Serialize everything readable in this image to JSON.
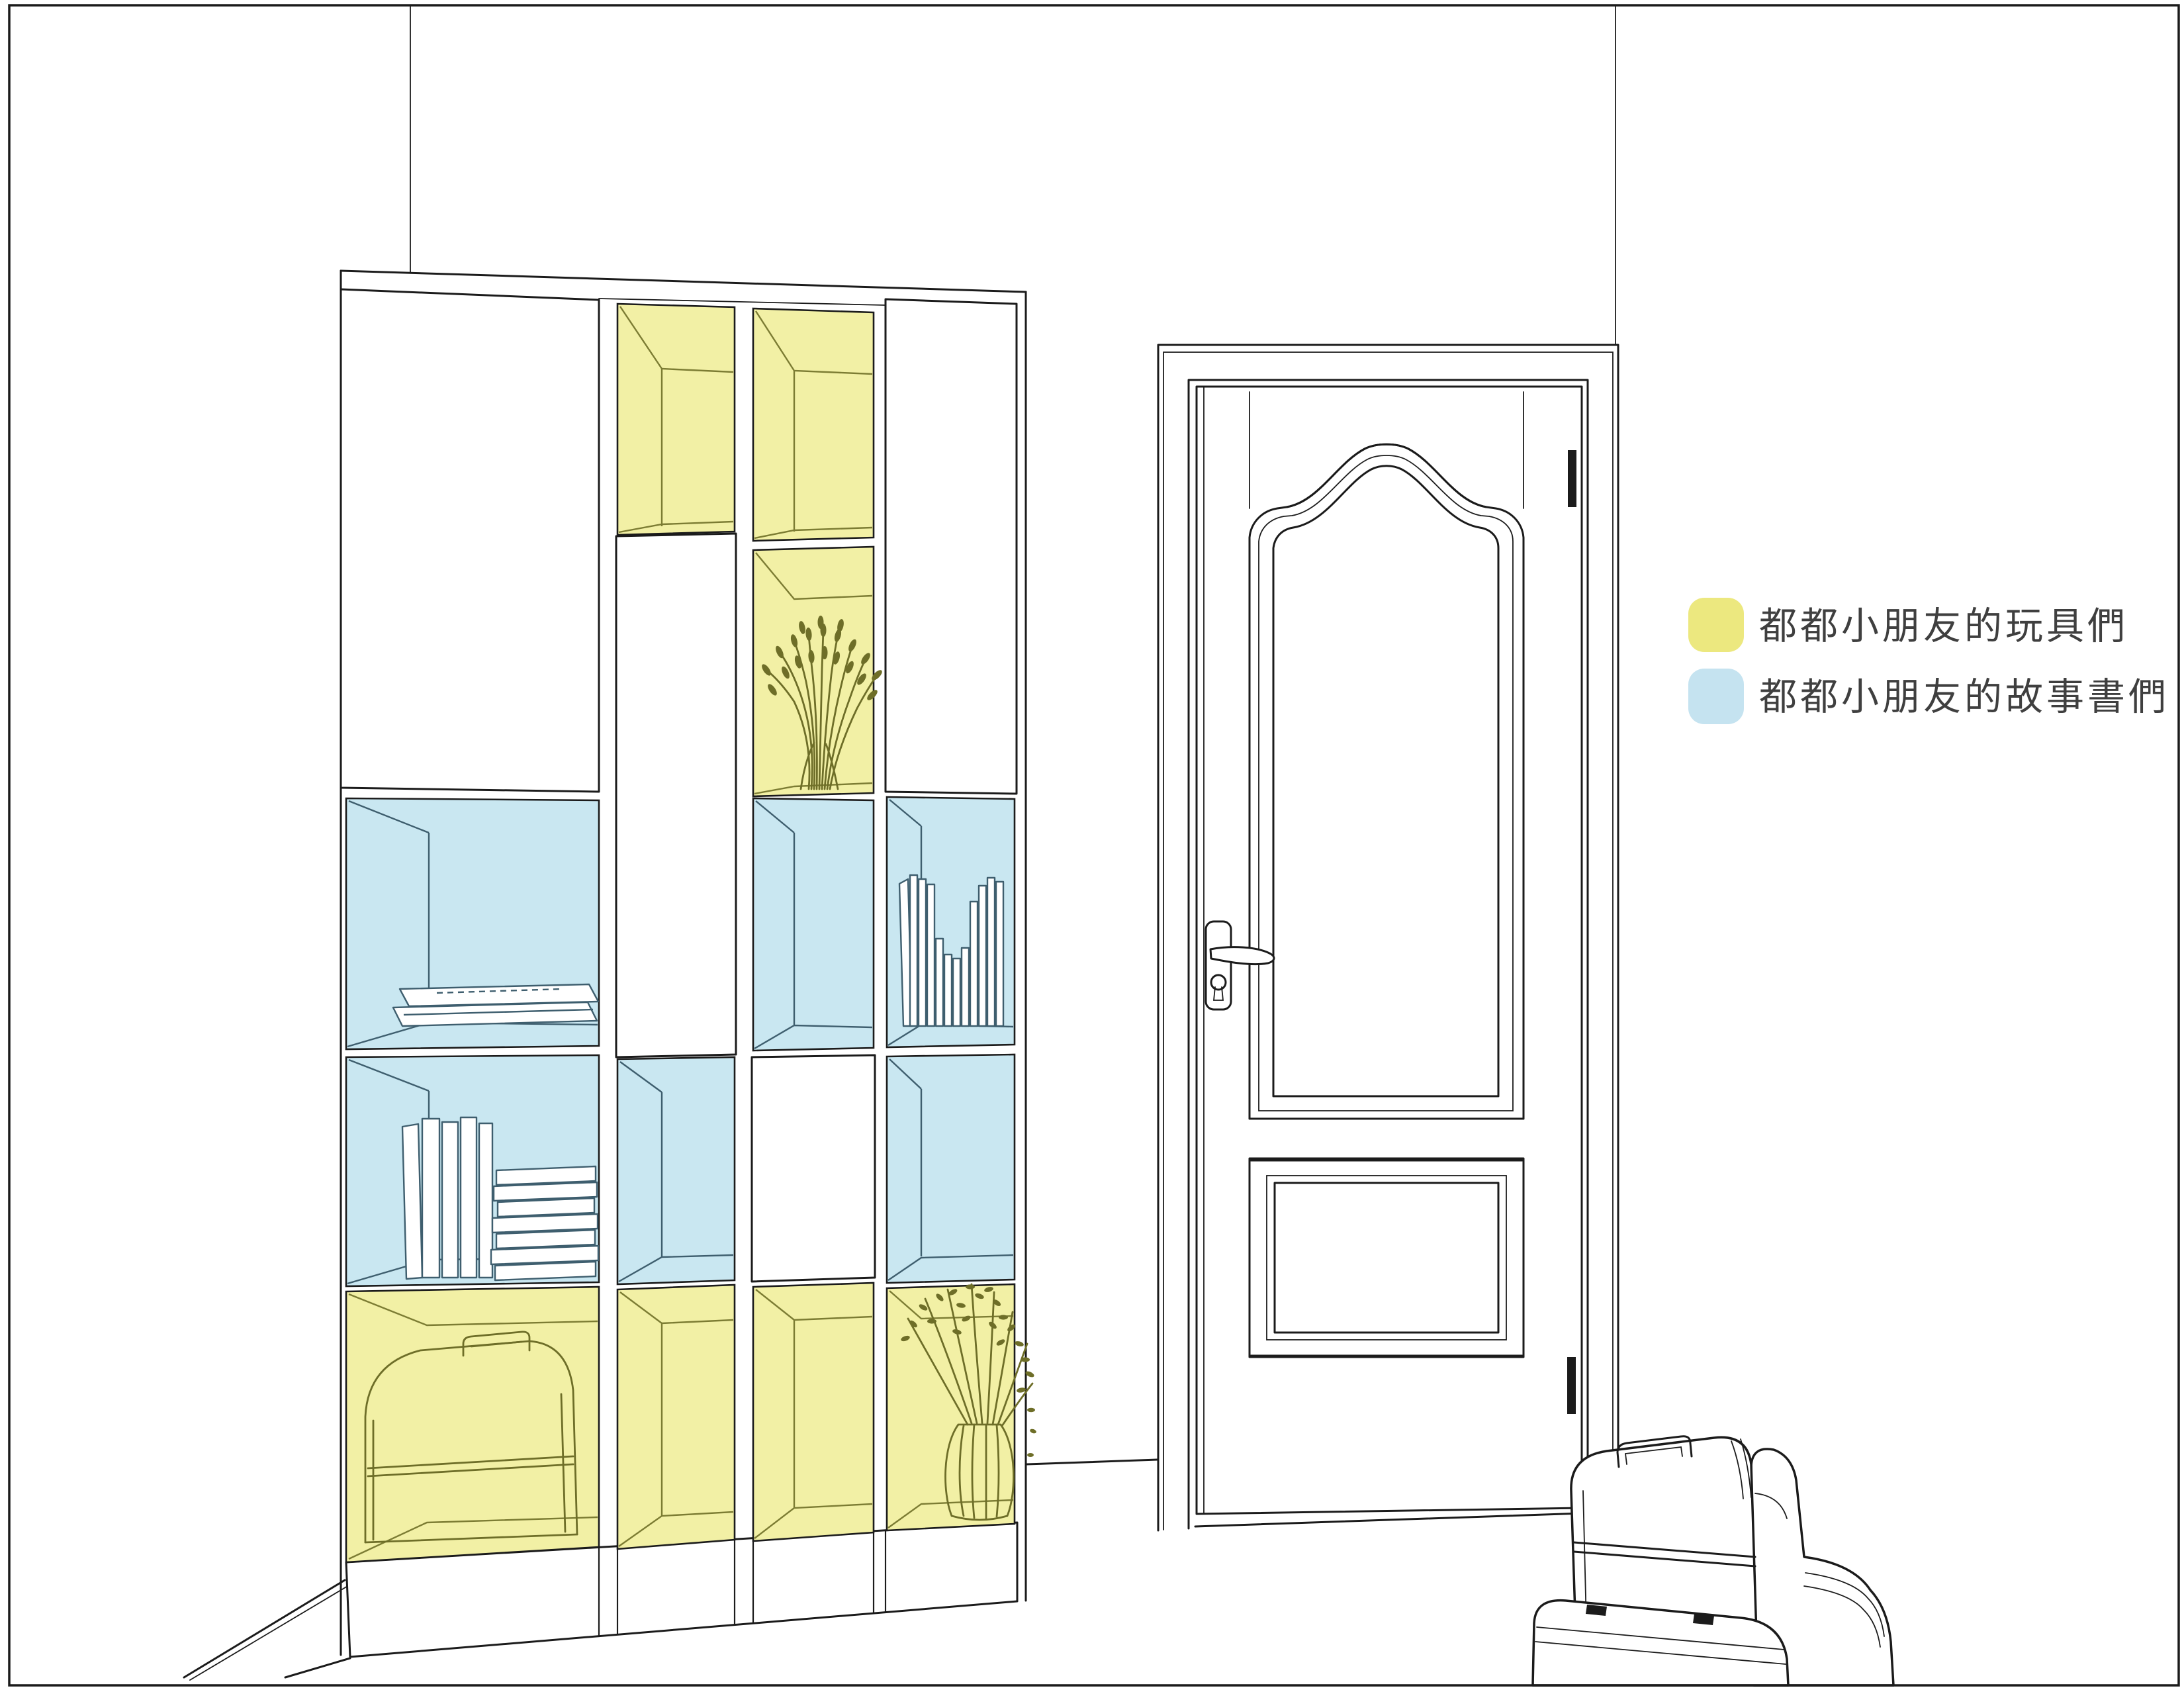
{
  "legend": {
    "items": [
      {
        "label": "都都小朋友的玩具們",
        "swatch_color": "#ece87f"
      },
      {
        "label": "都都小朋友的故事書們",
        "swatch_color": "#c5e3f0"
      }
    ]
  },
  "colors": {
    "outline": "#1b1b1b",
    "background": "#ffffff",
    "toys_fill": "#f2f0a5",
    "toys_line": "#7c7c33",
    "plant_line": "#6e6e28",
    "books_fill": "#c9e7f1",
    "books_line": "#3e5e6e",
    "legend_text": "#3f3f3f"
  }
}
